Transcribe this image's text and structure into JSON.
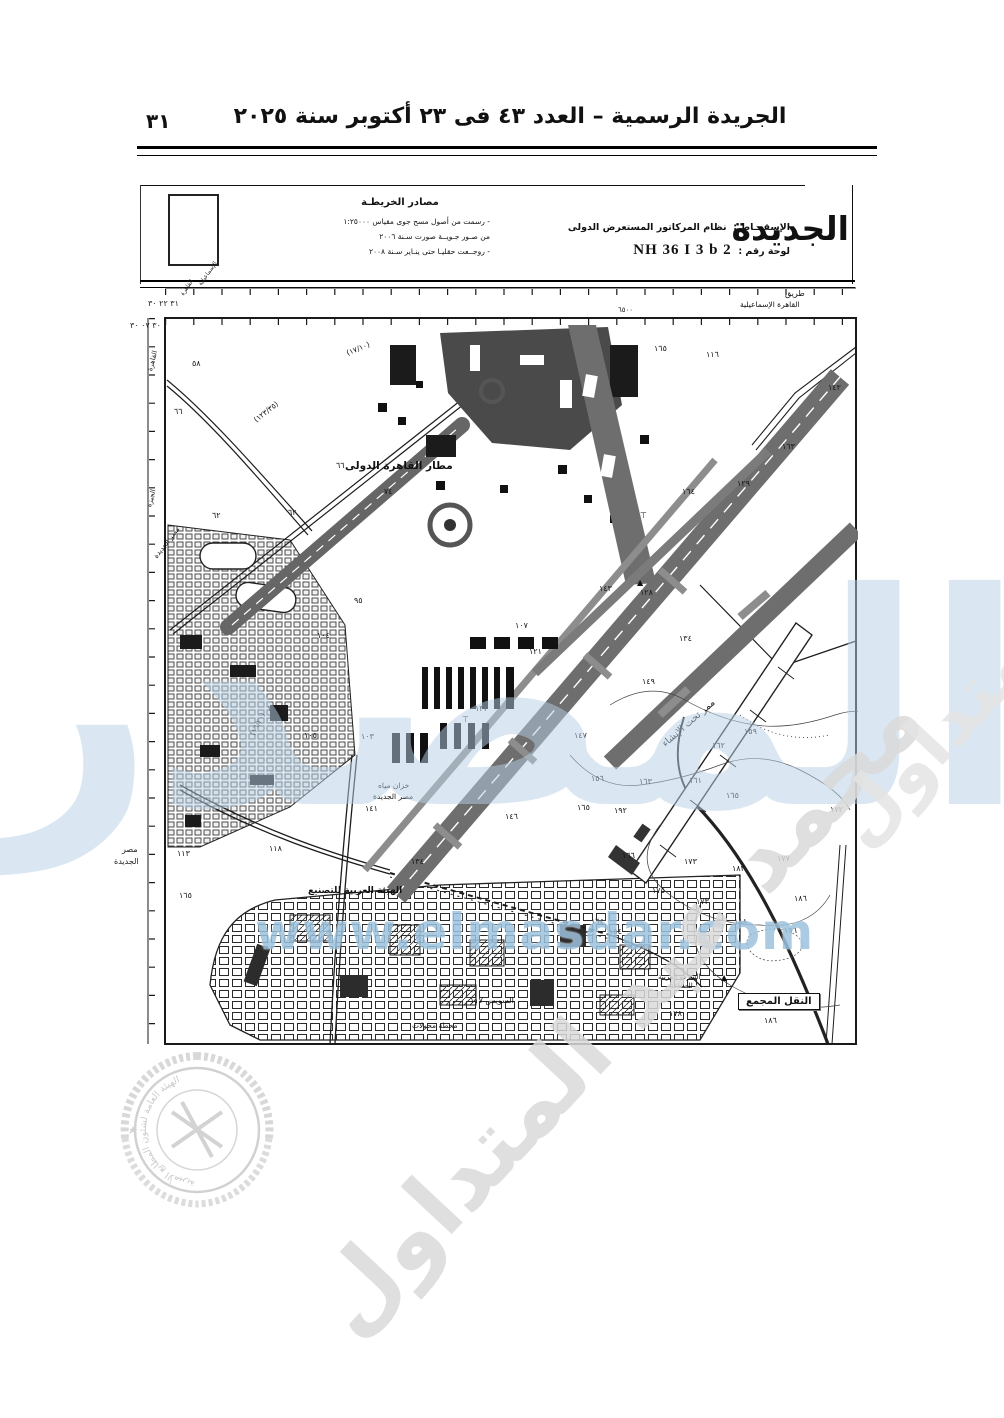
{
  "page": {
    "number": "٣١"
  },
  "header": {
    "title": "الجريدة الرسمية – العدد ٤٣ فى ٢٣ أكتوبر سنة ٢٠٢٥"
  },
  "title_block": {
    "sources_heading": "مصادر الخريطـة",
    "sources_lines": [
      "- رسمت من أصول مسح جوى مقياس ١:٢٥٠٠٠",
      "من صـور جـويــة صورت سـنة ٢٠٠٦",
      "- روجــعت حقليـا حتى ينـاير سـنة ٢٠٠٨"
    ],
    "projection_label": "الإسقـــاط :",
    "projection_value": "نظام المركاتور المستعرض الدولى",
    "sheet_label": "لوحة رقم :",
    "sheet_value": "NH 36 I 3 b 2",
    "partial_title": "الجديدة"
  },
  "map": {
    "labels": [
      {
        "t": "مطار القاهرة الدولى",
        "x": 205,
        "y": 175,
        "s": 10.5,
        "b": 1
      },
      {
        "t": "طريق",
        "x": 645,
        "y": 4,
        "s": 8
      },
      {
        "t": "القاهرة الإسماعيلية",
        "x": 600,
        "y": 15,
        "s": 7.5
      },
      {
        "t": "ممر تحت الإنشاء",
        "x": 520,
        "y": 456,
        "s": 9.5,
        "r": -41
      },
      {
        "t": "خزان مياه",
        "x": 238,
        "y": 496,
        "s": 7.5
      },
      {
        "t": "مصر الجديدة",
        "x": 233,
        "y": 507,
        "s": 7.5
      },
      {
        "t": "الهيئة العربية للتصنيع",
        "x": 168,
        "y": 601,
        "s": 9,
        "b": 1
      },
      {
        "t": "السويس ١١٧",
        "x": 330,
        "y": 711,
        "s": 8
      },
      {
        "t": "محطة محولات",
        "x": 272,
        "y": 736,
        "s": 7.5
      },
      {
        "t": "الشركة العربية",
        "x": 518,
        "y": 688,
        "s": 7
      },
      {
        "t": "للصناعة",
        "x": 530,
        "y": 697,
        "s": 7
      },
      {
        "t": "النقل المجمع",
        "x": 598,
        "y": 708,
        "s": 10,
        "b": 1,
        "boxed": 1
      },
      {
        "t": "مصر الجديدة",
        "x": 12,
        "y": 270,
        "s": 7,
        "r": -52
      },
      {
        "t": "(١٢٣/٣٥)",
        "x": 112,
        "y": 132,
        "s": 7.5,
        "r": -38
      },
      {
        "t": "(١٧/١٠)",
        "x": 205,
        "y": 64,
        "s": 7.5,
        "r": -22
      },
      {
        "t": "(١٦/٢٠)",
        "x": 108,
        "y": 448,
        "s": 7.5,
        "r": -64
      },
      {
        "t": "٦٥٠٠",
        "x": 478,
        "y": 21,
        "s": 7
      }
    ],
    "spot_heights": [
      {
        "v": "٥٨",
        "x": 52,
        "y": 74
      },
      {
        "v": "٦٦",
        "x": 34,
        "y": 122
      },
      {
        "v": "٦٢",
        "x": 72,
        "y": 226
      },
      {
        "v": "٦٢",
        "x": 148,
        "y": 223
      },
      {
        "v": "٦٦",
        "x": 196,
        "y": 176
      },
      {
        "v": "٧٤",
        "x": 244,
        "y": 202
      },
      {
        "v": "٩٥",
        "x": 214,
        "y": 311
      },
      {
        "v": "١٠٤",
        "x": 177,
        "y": 346
      },
      {
        "v": "١٠٧",
        "x": 375,
        "y": 336
      },
      {
        "v": "١٢١",
        "x": 389,
        "y": 362
      },
      {
        "v": "١٣٣",
        "x": 335,
        "y": 419
      },
      {
        "v": "١٠٤",
        "x": 127,
        "y": 419
      },
      {
        "v": "١٠٥",
        "x": 164,
        "y": 446
      },
      {
        "v": "١٠٣",
        "x": 221,
        "y": 447
      },
      {
        "v": "١٤١",
        "x": 225,
        "y": 519
      },
      {
        "v": "١٤٦",
        "x": 365,
        "y": 527
      },
      {
        "v": "١١٨",
        "x": 129,
        "y": 559
      },
      {
        "v": "١١٣",
        "x": 37,
        "y": 564
      },
      {
        "v": "١٣٤",
        "x": 271,
        "y": 572
      },
      {
        "v": "١٦٥",
        "x": 39,
        "y": 606
      },
      {
        "v": "١٦٥",
        "x": 514,
        "y": 59
      },
      {
        "v": "١١٦",
        "x": 566,
        "y": 65
      },
      {
        "v": "١٤٢",
        "x": 688,
        "y": 98
      },
      {
        "v": "١٦٣",
        "x": 642,
        "y": 157
      },
      {
        "v": "١٢٩",
        "x": 597,
        "y": 194
      },
      {
        "v": "١٦٤",
        "x": 542,
        "y": 202
      },
      {
        "v": "١٤٣",
        "x": 459,
        "y": 299
      },
      {
        "v": "١٢٨",
        "x": 500,
        "y": 303
      },
      {
        "v": "١٣٤",
        "x": 539,
        "y": 349
      },
      {
        "v": "١٤٩",
        "x": 502,
        "y": 392
      },
      {
        "v": "١٤٧",
        "x": 434,
        "y": 446
      },
      {
        "v": "١٦٢",
        "x": 572,
        "y": 456
      },
      {
        "v": "١٥٩",
        "x": 604,
        "y": 442
      },
      {
        "v": "١٥٦",
        "x": 451,
        "y": 489
      },
      {
        "v": "١٦١",
        "x": 549,
        "y": 491
      },
      {
        "v": "١٦٣",
        "x": 499,
        "y": 492
      },
      {
        "v": "١٦٥",
        "x": 586,
        "y": 506
      },
      {
        "v": "١٩٢",
        "x": 474,
        "y": 521
      },
      {
        "v": "١٦٦",
        "x": 482,
        "y": 566
      },
      {
        "v": "١٧٣",
        "x": 544,
        "y": 572
      },
      {
        "v": "١٨٢",
        "x": 592,
        "y": 579
      },
      {
        "v": "١٧٧",
        "x": 637,
        "y": 569
      },
      {
        "v": "١٨٦",
        "x": 654,
        "y": 609
      },
      {
        "v": "١٧٥",
        "x": 512,
        "y": 601
      },
      {
        "v": "١٨٨",
        "x": 594,
        "y": 632
      },
      {
        "v": "١٩٦",
        "x": 644,
        "y": 641
      },
      {
        "v": "١٦٤",
        "x": 451,
        "y": 632
      },
      {
        "v": "١٥٤",
        "x": 469,
        "y": 642
      },
      {
        "v": "١٧٨",
        "x": 529,
        "y": 724
      },
      {
        "v": "١٨٦",
        "x": 624,
        "y": 731
      },
      {
        "v": "١٧٢",
        "x": 690,
        "y": 520
      },
      {
        "v": "١٧٣",
        "x": 556,
        "y": 612
      },
      {
        "v": "١٦٥",
        "x": 437,
        "y": 518
      }
    ],
    "symbols": [
      {
        "g": "▲",
        "x": 497,
        "y": 293
      },
      {
        "g": "▲",
        "x": 581,
        "y": 688
      },
      {
        "g": "⊤",
        "x": 500,
        "y": 226
      },
      {
        "g": "⊤",
        "x": 322,
        "y": 430
      }
    ],
    "margin_labels": [
      {
        "t": "٣١ ٢٢ ٣٠",
        "x": 148,
        "y": 299,
        "s": 8
      },
      {
        "t": "٣٠ ٠٧ ٣٠",
        "x": 130,
        "y": 321,
        "s": 8
      },
      {
        "t": "الإسماعيلية",
        "x": 197,
        "y": 283,
        "s": 6,
        "r": -55
      },
      {
        "t": "القاهرة",
        "x": 179,
        "y": 293,
        "s": 6,
        "r": -55
      },
      {
        "t": "القاهرة",
        "x": 146,
        "y": 370,
        "s": 7,
        "r": -75
      },
      {
        "t": "الجيزة",
        "x": 145,
        "y": 506,
        "s": 7,
        "r": -75
      },
      {
        "t": "مصر",
        "x": 122,
        "y": 845,
        "s": 8
      },
      {
        "t": "الجديدة",
        "x": 114,
        "y": 857,
        "s": 8
      }
    ]
  },
  "watermarks": {
    "big_text": "المصدر",
    "url_text": "www.elmasdar.com",
    "diagonal_text": "محمد عبد المتداول",
    "seal_text": "الهيئة العامة لشئون المطابع الأميرية",
    "accent_blue": "#9dc2dd",
    "seal_gray": "#c4c4c4"
  }
}
